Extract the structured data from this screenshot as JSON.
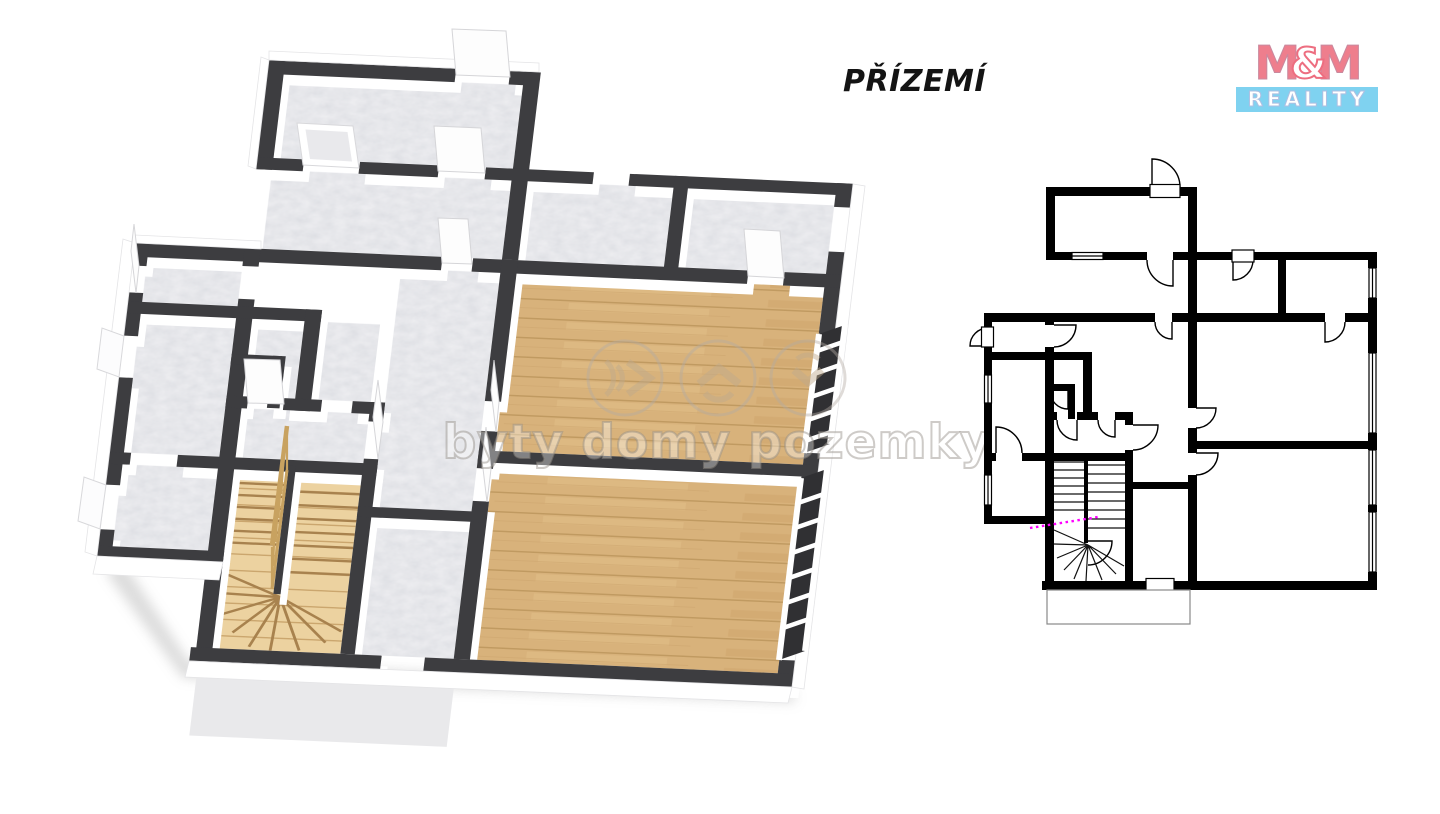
{
  "page": {
    "title": "PŘÍZEMÍ",
    "background": "#ffffff"
  },
  "logo": {
    "m1": "M",
    "amp": "&",
    "m2": "M",
    "reality": "REALITY",
    "colors": {
      "letters": "#ee7e8d",
      "amp_fill": "#ffffff",
      "bar": "#7fd2f0",
      "bar_text": "#ffffff"
    }
  },
  "watermark": {
    "text": "byty domy pozemky",
    "icons": [
      "sound-waves-forward-icon",
      "house-roof-icon",
      "down-arrow-icon"
    ]
  },
  "colors": {
    "wall_2d": "#000000",
    "wall_3d": "#3d3d40",
    "wall_face": "#ffffff",
    "marble": "#efeff2",
    "wood": "#d8b27b",
    "wood_light": "#ecd2a0",
    "porch": "#e9e9eb",
    "section_line": "#ff00ff",
    "shadow": "#9a9a9a"
  }
}
